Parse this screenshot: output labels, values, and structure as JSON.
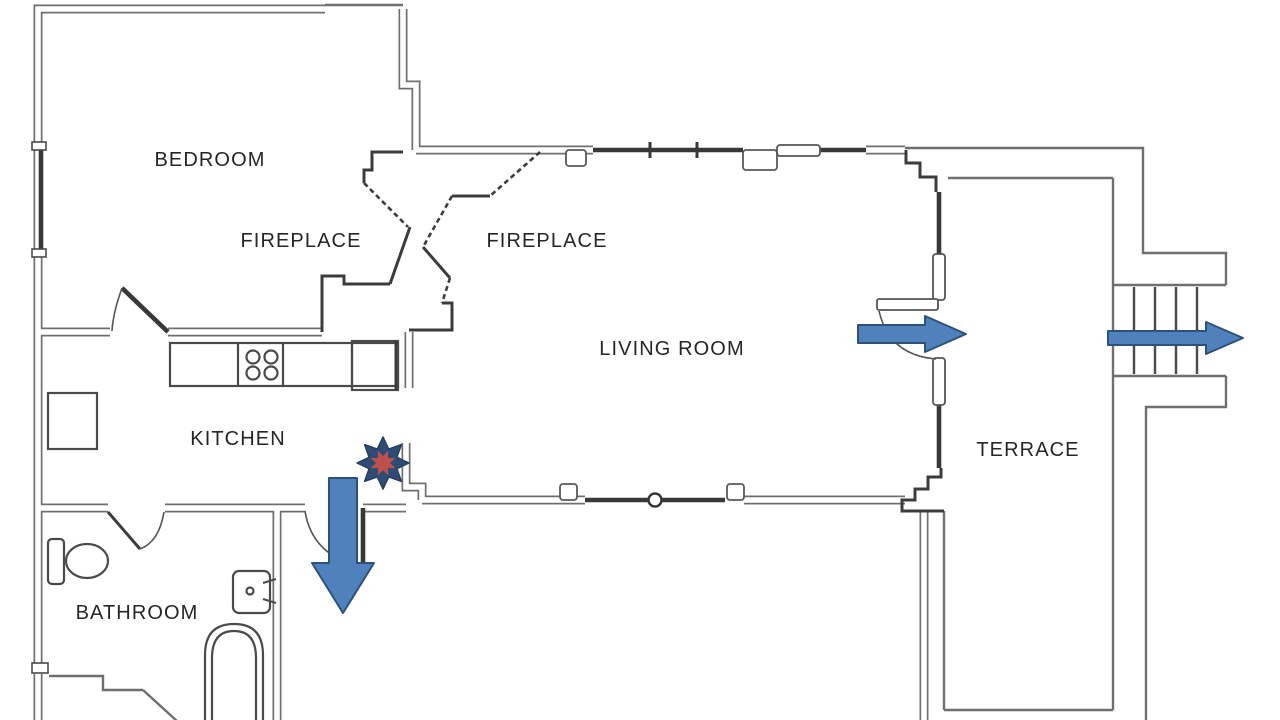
{
  "page": {
    "background": "#ffffff",
    "type": "apartment floor plan with evacuation routes"
  },
  "rooms": [
    {
      "id": "bedroom",
      "label": "BEDROOM"
    },
    {
      "id": "fireplace-bedroom",
      "label": "FIREPLACE"
    },
    {
      "id": "fireplace-living",
      "label": "FIREPLACE"
    },
    {
      "id": "living-room",
      "label": "LIVING ROOM"
    },
    {
      "id": "kitchen",
      "label": "KITCHEN"
    },
    {
      "id": "bathroom",
      "label": "BATHROOM"
    },
    {
      "id": "terrace",
      "label": "TERRACE"
    }
  ],
  "evacuation": {
    "arrow_fill": "#4f81bd",
    "arrow_border": "#2e5277",
    "fire_star": {
      "outer_color": "#2e4d76",
      "inner_color": "#c0504d",
      "location": "kitchen doorway"
    },
    "arrows": [
      {
        "id": "kitchen-exit",
        "direction": "down"
      },
      {
        "id": "living-room-to-terrace",
        "direction": "right"
      },
      {
        "id": "stairs-exit",
        "direction": "right"
      }
    ]
  },
  "stairs": {
    "step_lines": 4
  },
  "fixtures": {
    "kitchen": [
      "counter",
      "stove-4-burners",
      "appliance",
      "window-bay"
    ],
    "bathroom": [
      "toilet",
      "sink",
      "bathtub"
    ]
  },
  "wall_colors": {
    "outline": "#6f6f6f",
    "solid": "#383838"
  }
}
